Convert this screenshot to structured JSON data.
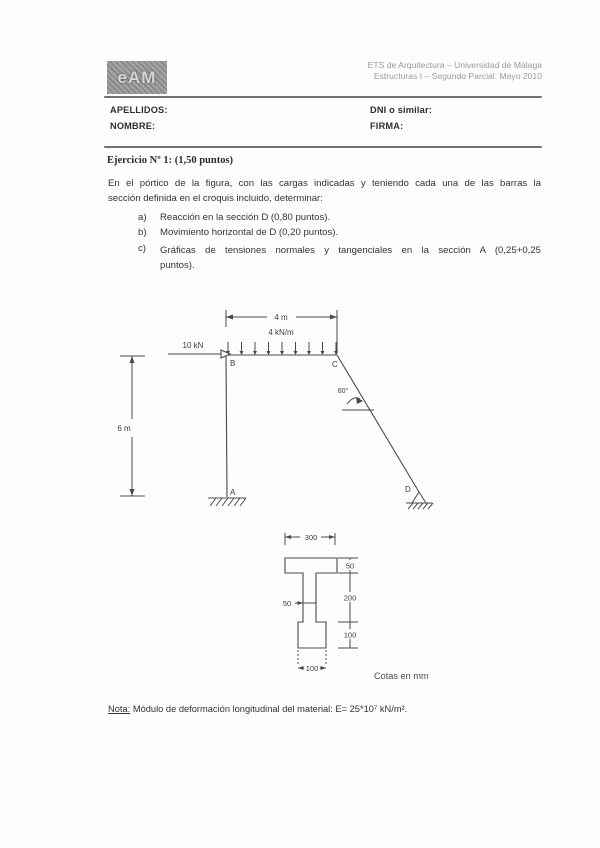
{
  "header": {
    "logo_text": "eAM",
    "institution_line1": "ETS de Arquitectura – Universidad de Málaga",
    "institution_line2": "Estructuras I – Segundo Parcial. Mayo 2010",
    "fields": {
      "apellidos": "APELLIDOS:",
      "nombre": "NOMBRE:",
      "dni": "DNI o similar:",
      "firma": "FIRMA:"
    }
  },
  "exercise": {
    "title": "Ejercicio Nº 1: (1,50 puntos)",
    "intro_line1": "En el pórtico de la figura, con las cargas indicadas y teniendo cada una de las barras la",
    "intro_line2": "sección definida en el croquis incluido, determinar:",
    "items": [
      {
        "marker": "a)",
        "text": "Reacción en la sección D (0,80 puntos)."
      },
      {
        "marker": "b)",
        "text": "Movimiento horizontal de D (0,20 puntos)."
      },
      {
        "marker": "c)",
        "line1": "Gráficas de tensiones normales y tangenciales en la sección A (0,25+0,25",
        "line2": "puntos)."
      }
    ]
  },
  "frame_diagram": {
    "span_label": "4 m",
    "distributed_load_label": "4 kN/m",
    "point_load_label": "10 kN",
    "height_label": "6 m",
    "angle_label": "60°",
    "node_a": "A",
    "node_b": "B",
    "node_c": "C",
    "node_d": "D"
  },
  "section_diagram": {
    "flange_width": "300",
    "flange_thickness": "50",
    "web_height": "200",
    "block_height": "100",
    "web_width": "50",
    "block_width": "100",
    "units_note": "Cotas en mm"
  },
  "footer_note": {
    "label": "Nota:",
    "text": "Módulo de deformación longitudinal del material: E= 25*10⁷ kN/m²."
  }
}
